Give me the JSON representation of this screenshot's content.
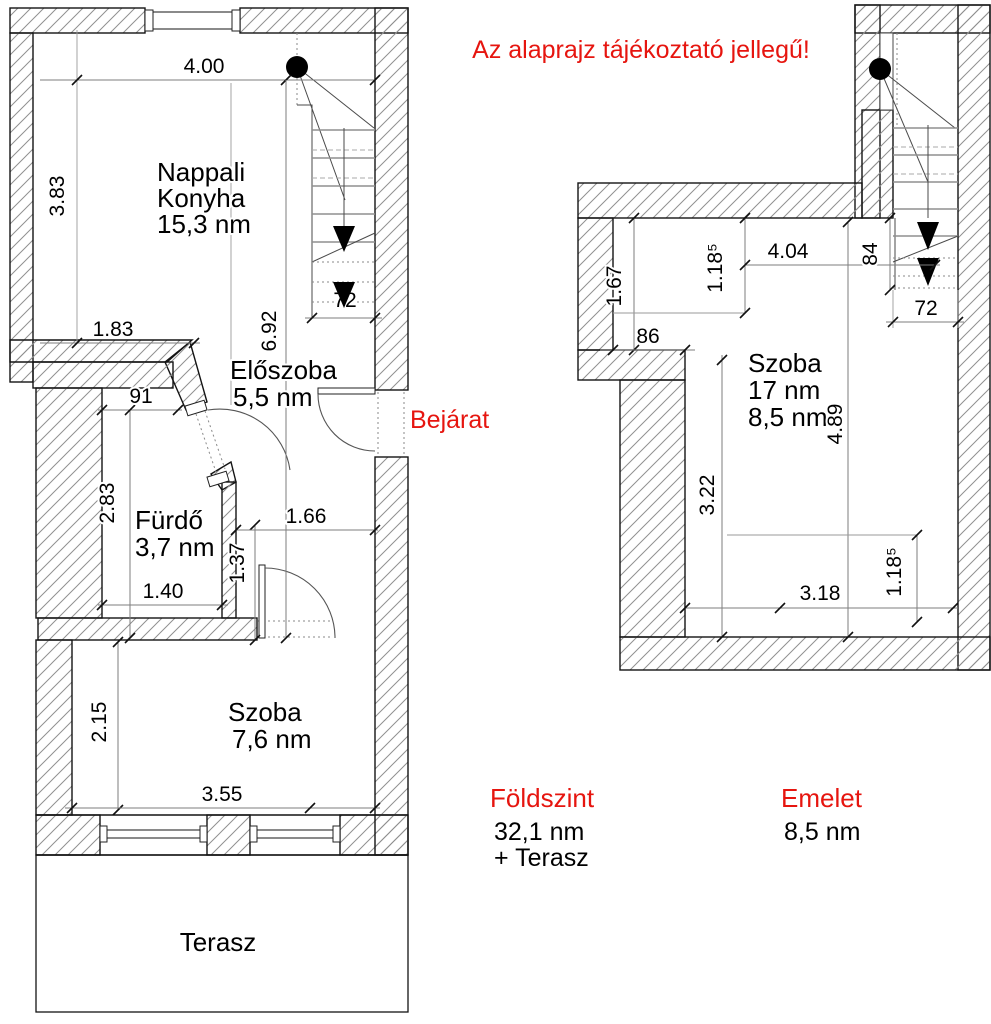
{
  "disclaimer": "Az alaprajz tájékoztató jellegű!",
  "colors": {
    "accent": "#e6150f",
    "ink": "#000000",
    "hatch": "#909090"
  },
  "ground_floor": {
    "rooms": {
      "living_kitchen": {
        "line1": "Nappali",
        "line2": "Konyha",
        "area": "15,3 nm"
      },
      "hallway": {
        "name": "Előszoba",
        "area": "5,5 nm"
      },
      "bathroom": {
        "name": "Fürdő",
        "area": "3,7 nm"
      },
      "room": {
        "name": "Szoba",
        "area": "7,6 nm"
      },
      "terrace": {
        "name": "Terasz"
      }
    },
    "entrance_label": "Bejárat",
    "dims": {
      "top_width": "4.00",
      "left_height": "3.83",
      "living_bottom": "1.83",
      "hall_height": "6.92",
      "stair_bottom": "72",
      "bath_top": "91",
      "bath_height": "2.83",
      "bath_bottom": "1.40",
      "passage_height": "1.37",
      "hall_width": "1.66",
      "room_height": "2.15",
      "room_width": "3.55"
    },
    "summary": {
      "title": "Földszint",
      "area": "32,1 nm",
      "extra": "+ Terasz"
    }
  },
  "upper_floor": {
    "rooms": {
      "room": {
        "name": "Szoba",
        "area_total": "17 nm",
        "area_net": "8,5 nm"
      }
    },
    "dims": {
      "nook_height": "1.67",
      "top_height": "1.18⁵",
      "top_width": "4.04",
      "stair_width": "84",
      "stair_bottom": "72",
      "nook_width": "86",
      "left_height": "3.22",
      "room_height": "4.89",
      "bottom_width": "3.18",
      "bottom_height": "1.18⁵"
    },
    "summary": {
      "title": "Emelet",
      "area": "8,5 nm"
    }
  }
}
